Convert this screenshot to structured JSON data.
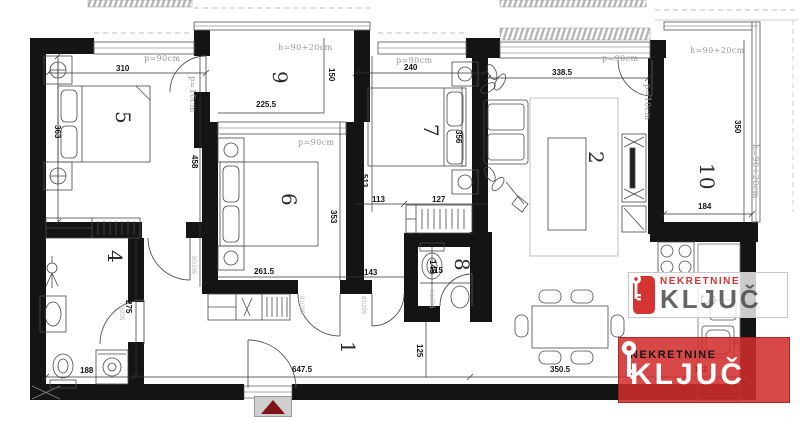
{
  "rooms": {
    "n1": "1",
    "n2": "2",
    "n3": "3",
    "n4": "4",
    "n5": "5",
    "n6": "6",
    "n7": "7",
    "n8": "8",
    "n9": "9",
    "n10": "10"
  },
  "dims": {
    "w310": "310",
    "h363": "363",
    "h458": "458",
    "w225_5": "225.5",
    "h150": "150",
    "w240": "240",
    "h356": "356",
    "h513": "513",
    "w113": "113",
    "w127": "127",
    "w338_5": "338.5",
    "h350": "350",
    "w184": "184",
    "h353": "353",
    "w261_5": "261.5",
    "w143": "143",
    "w115": "115",
    "h145": "145",
    "h275": "275",
    "w188": "188",
    "w647_5": "647.5",
    "h125": "125",
    "w350_5": "350.5",
    "w182": "182"
  },
  "labels": {
    "p90": "p=90cm",
    "p10": "p=10cm",
    "h90": "h=90+20cm",
    "d80": "80/205",
    "d81": "81/205",
    "d61": "61/205",
    "d70": "70/205"
  },
  "logo": {
    "brand_top": "NEKRETNINE",
    "brand_main": "KLJUČ"
  },
  "colors": {
    "logo_red": "#d63333",
    "logo_dark": "#4a4a4a",
    "marker_red": "#7e1416"
  }
}
